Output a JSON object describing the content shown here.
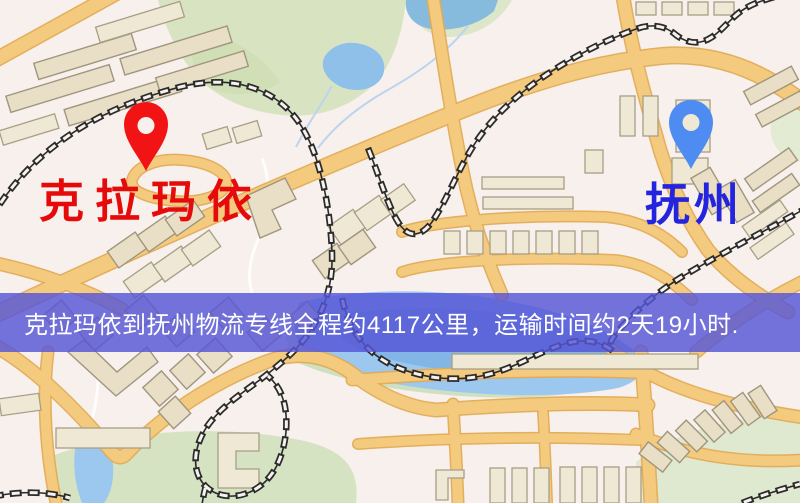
{
  "map": {
    "type": "route-map",
    "markers": [
      {
        "id": "origin",
        "name": "克拉玛依",
        "pin_color": "#f21414",
        "label_color": "#e60b0b"
      },
      {
        "id": "destination",
        "name": "抚州",
        "pin_color": "#4e8cf2",
        "label_color": "#2424de"
      }
    ],
    "palette": {
      "background": "#f7f0ec",
      "road": "#f4ca7e",
      "road_casing": "#e2ab55",
      "building": "#e8dfc6",
      "building_outline": "#a0967e",
      "park": "#d8e3c2",
      "water": "#8fc0ea",
      "railway": "#2b2b2b",
      "banner_background": "#5656d7",
      "banner_text": "#ffffff"
    }
  },
  "banner": {
    "text": "克拉玛依到抚州物流专线全程约4117公里，运输时间约2天19小时.",
    "distance_km": "4117",
    "distance_text": "约4117公里",
    "duration_text": "约2天19小时"
  }
}
